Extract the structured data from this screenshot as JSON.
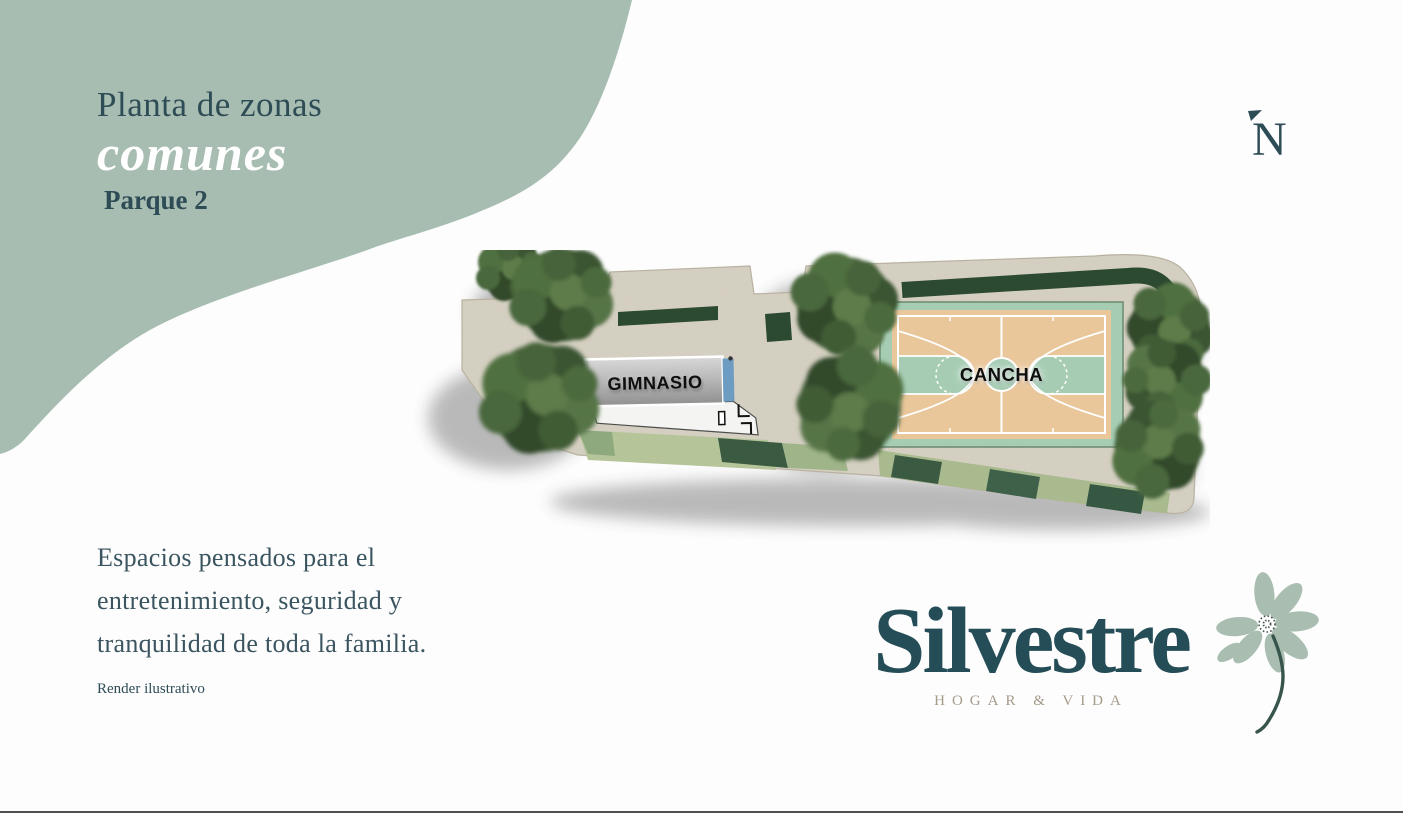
{
  "header": {
    "title_line1": "Planta de zonas",
    "title_line2": "comunes",
    "subtitle": "Parque 2"
  },
  "north": {
    "label": "N"
  },
  "plan": {
    "gym_label": "GIMNASIO",
    "court_label": "CANCHA"
  },
  "description": {
    "lines": [
      "Espacios pensados para el",
      "entretenimiento, seguridad y",
      "tranquilidad de toda la familia."
    ],
    "note": "Render ilustrativo"
  },
  "brand": {
    "name": "Silvestre",
    "tagline": "HOGAR & VIDA"
  },
  "colors": {
    "sage": "#a8bdb1",
    "teal": "#2e4c56",
    "title_accent": "#ffffff",
    "body_text": "#3a5560",
    "brand_teal": "#254d57",
    "tagline": "#a59b8a",
    "plaza_beige": "#d8d3c5",
    "court_tan": "#eac79b",
    "court_mint": "#a6cdb4",
    "hedge_green": "#2c4a31",
    "lawn_light": "#b5c499",
    "lawn_dark": "#3a5a41",
    "building_gray": "#b5b5b5",
    "roof_blue": "#6d9cc3",
    "tree_green": "#425f38"
  }
}
